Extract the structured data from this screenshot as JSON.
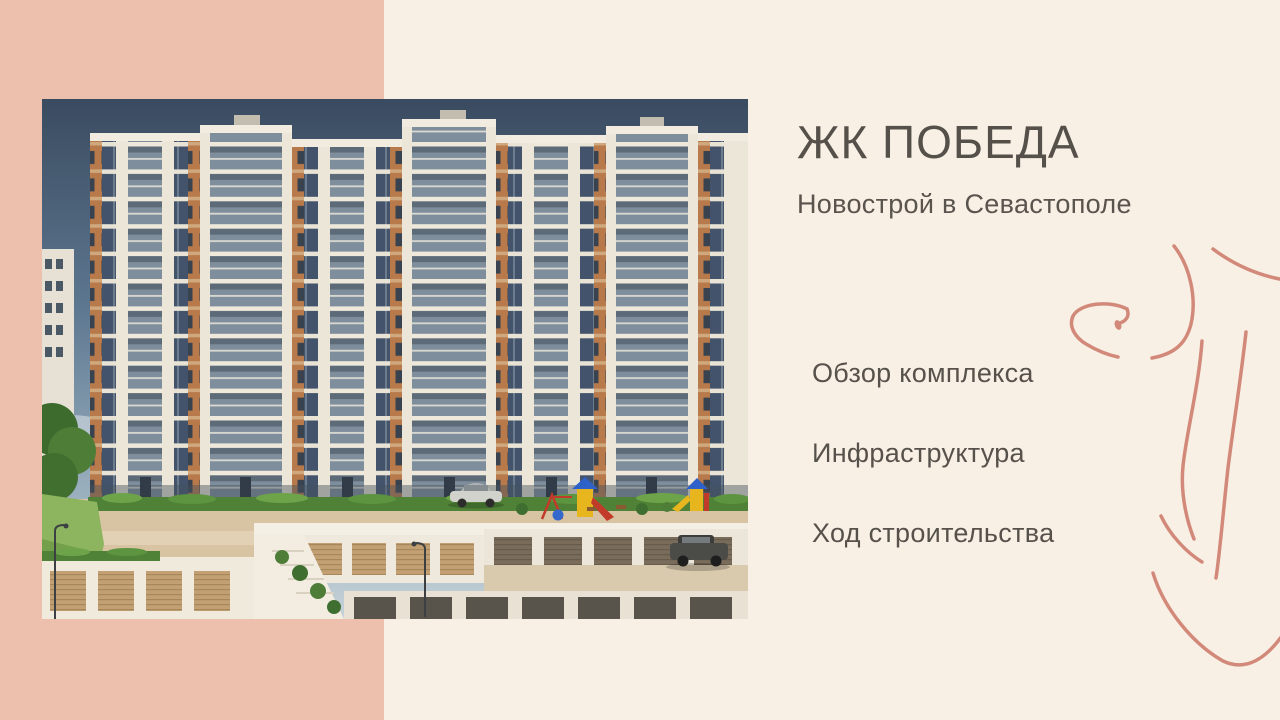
{
  "slide": {
    "title": "ЖК ПОБЕДА",
    "subtitle": "Новострой в Севастополе",
    "agenda": [
      {
        "label": "Обзор комплекса"
      },
      {
        "label": "Инфраструктура"
      },
      {
        "label": "Ход строительства"
      }
    ]
  },
  "colors": {
    "background": "#f8f0e5",
    "accent_panel": "#edc0ae",
    "line_art": "#d2897a",
    "heading_text": "#55504a",
    "render_sky_top": "#3a4b60",
    "render_facade": "#ece6d8",
    "render_orange_accent": "#b97a4b"
  }
}
